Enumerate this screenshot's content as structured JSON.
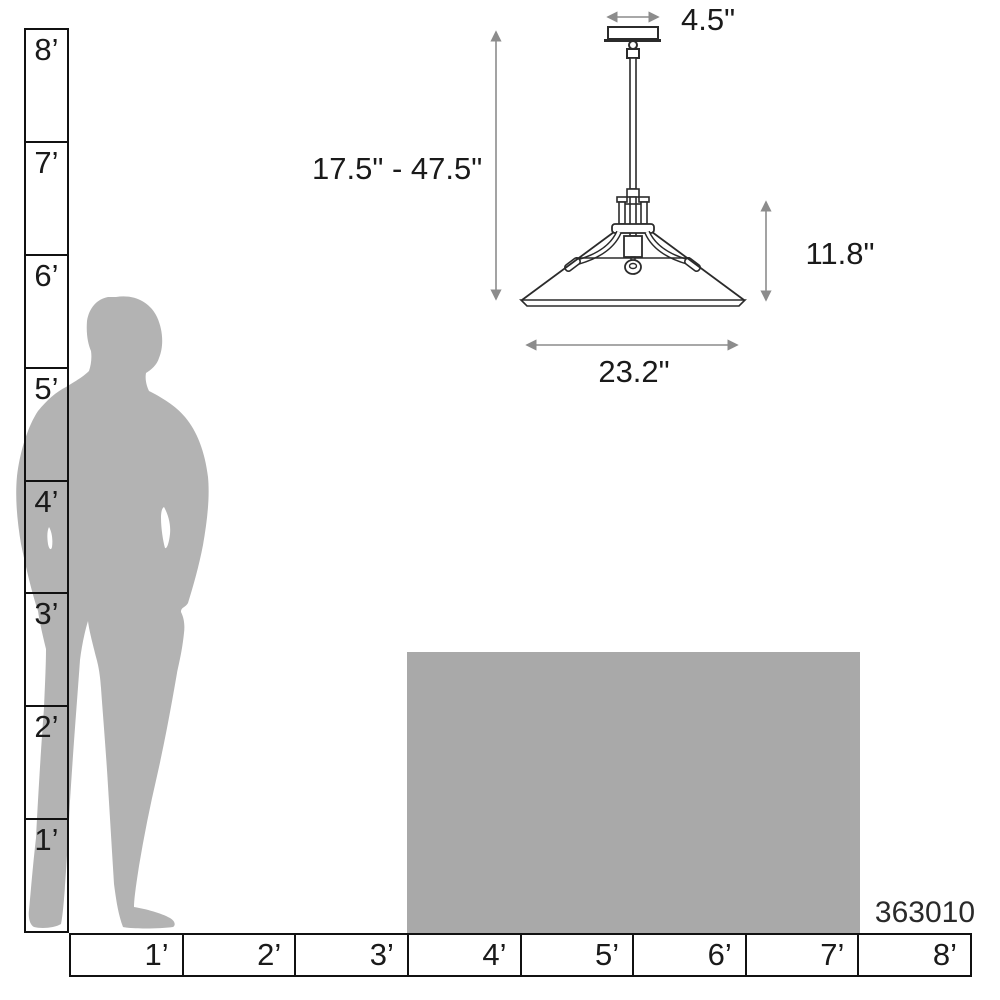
{
  "title": "Pendant light size comparison diagram",
  "product_code": "363010",
  "fixture": {
    "dimensions": {
      "canopy_width": "4.5\"",
      "height_range": "17.5\" - 47.5\"",
      "shade_height": "11.8\"",
      "shade_width": "23.2\""
    }
  },
  "rulers": {
    "vertical_feet": [
      "8’",
      "7’",
      "6’",
      "5’",
      "4’",
      "3’",
      "2’",
      "1’"
    ],
    "horizontal_feet": [
      "1’",
      "2’",
      "3’",
      "4’",
      "5’",
      "6’",
      "7’",
      "8’"
    ]
  },
  "colors": {
    "silhouette_gray": "#b3b3b3",
    "table_gray": "#a9a9a9",
    "line_black": "#111111",
    "fixture_line": "#2b2b2b",
    "dimension_gray": "#8c8c8c"
  }
}
